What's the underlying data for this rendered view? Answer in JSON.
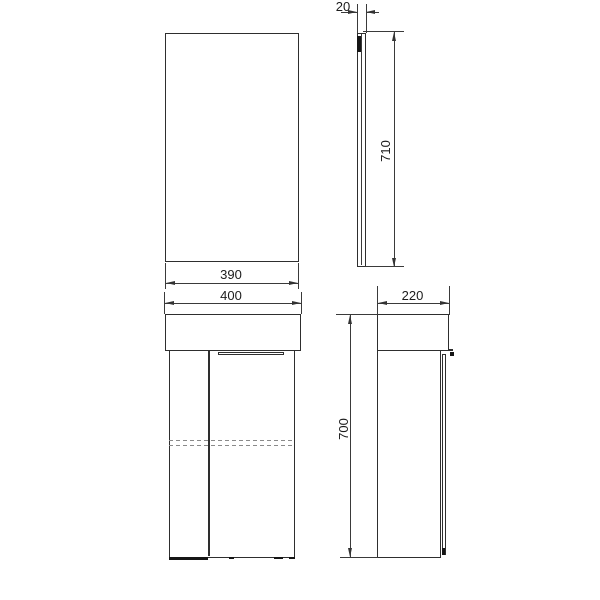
{
  "diagram": {
    "type": "furniture-technical-drawing",
    "labels": {
      "mirror_depth": "20",
      "mirror_height": "710",
      "mirror_width": "390",
      "cabinet_width": "400",
      "cabinet_depth": "220",
      "cabinet_height": "700"
    },
    "colors": {
      "line": "#2e2e2e",
      "dimension": "#333333",
      "hidden_line": "#8a8a8a",
      "background": "#ffffff"
    }
  }
}
